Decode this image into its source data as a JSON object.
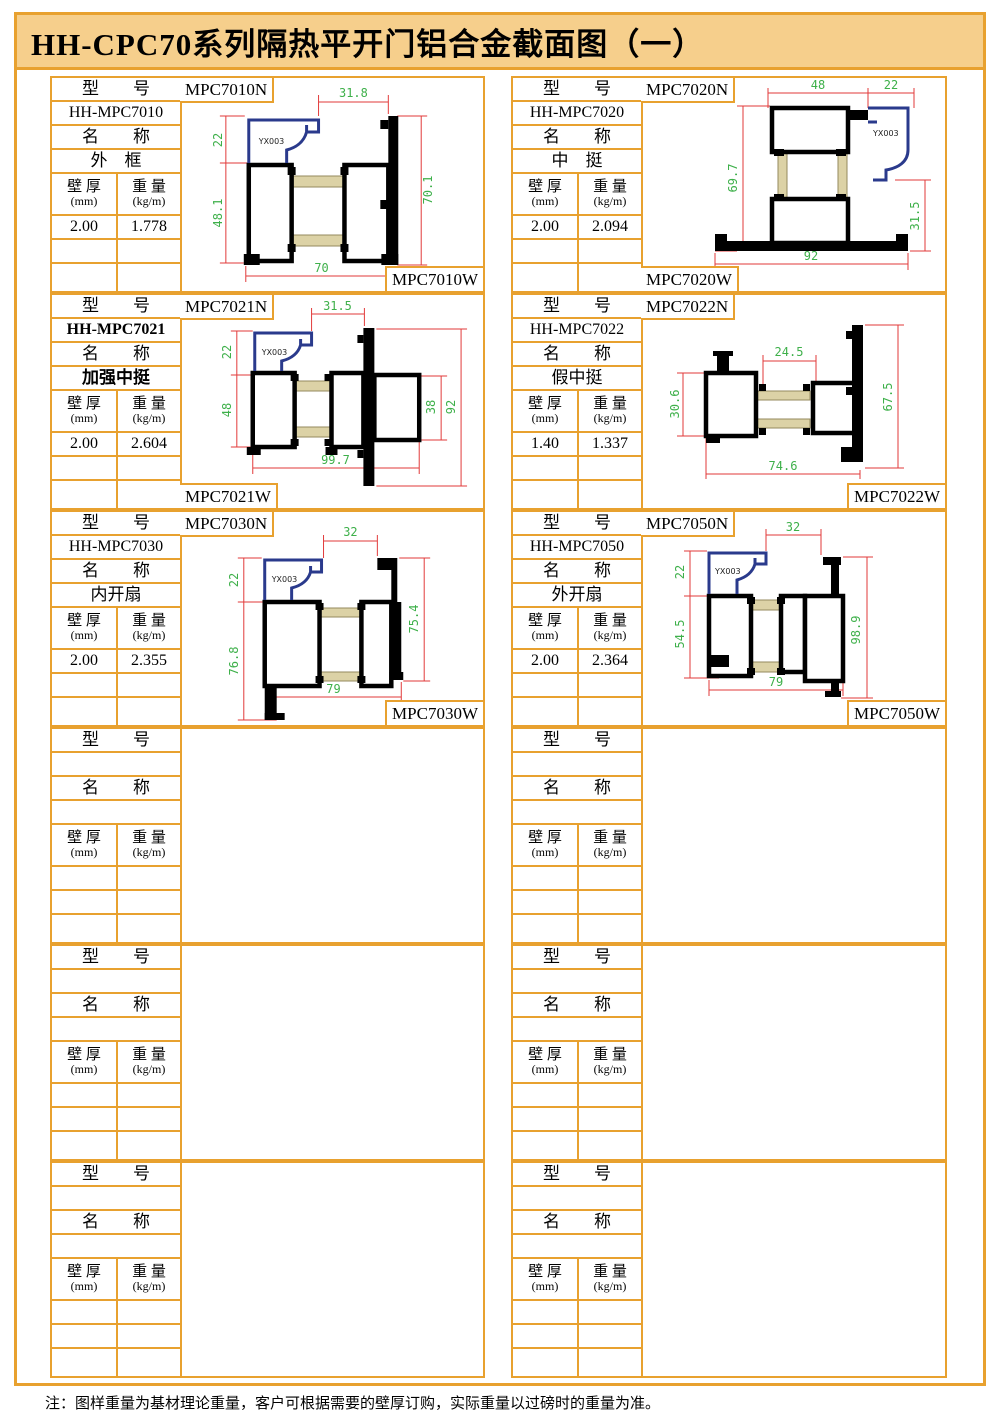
{
  "title": "HH-CPC70系列隔热平开门铝合金截面图（一）",
  "note": "注：图样重量为基材理论重量，客户可根据需要的壁厚订购，实际重量以过磅时的重量为准。",
  "labels": {
    "model": "型　　号",
    "name": "名　　称",
    "thickness": "壁 厚",
    "thickness_unit": "(mm)",
    "weight": "重 量",
    "weight_unit": "(kg/m)"
  },
  "colors": {
    "frame_orange": "#E8A12F",
    "title_bg": "#F6CF8C",
    "dimension_line_red": "#E23A3A",
    "dimension_text_green": "#3EB04A",
    "gasket_blue": "#2A3A8C",
    "thermal_break_tan": "#DCD2A6"
  },
  "cells": [
    {
      "model": "HH-MPC7010",
      "name": "外　框",
      "thickness": "2.00",
      "weight": "1.778",
      "label_n": "MPC7010N",
      "label_w": "MPC7010W",
      "gasket": "YX003",
      "dims": {
        "top": "31.8",
        "left_top": "22",
        "left": "48.1",
        "right": "70.1",
        "bottom": "70"
      }
    },
    {
      "model": "HH-MPC7020",
      "name": "中　挺",
      "thickness": "2.00",
      "weight": "2.094",
      "label_n": "MPC7020N",
      "label_w": "MPC7020W",
      "gasket": "YX003",
      "dims": {
        "top_left": "48",
        "top_right": "22",
        "left": "69.7",
        "right": "31.5",
        "bottom": "92"
      }
    },
    {
      "model": "HH-MPC7021",
      "name": "加强中挺",
      "thickness": "2.00",
      "weight": "2.604",
      "label_n": "MPC7021N",
      "label_w": "MPC7021W",
      "gasket": "YX003",
      "dims": {
        "top": "31.5",
        "left_top": "22",
        "left": "48",
        "mid": "38",
        "right": "92",
        "bottom": "99.7"
      }
    },
    {
      "model": "HH-MPC7022",
      "name": "假中挺",
      "thickness": "1.40",
      "weight": "1.337",
      "label_n": "MPC7022N",
      "label_w": "MPC7022W",
      "dims": {
        "top": "24.5",
        "left": "30.6",
        "right": "67.5",
        "bottom": "74.6"
      }
    },
    {
      "model": "HH-MPC7030",
      "name": "内开扇",
      "thickness": "2.00",
      "weight": "2.355",
      "label_n": "MPC7030N",
      "label_w": "MPC7030W",
      "gasket": "YX003",
      "dims": {
        "top": "32",
        "left_top": "22",
        "left": "76.8",
        "right": "75.4",
        "bottom": "79"
      }
    },
    {
      "model": "HH-MPC7050",
      "name": "外开扇",
      "thickness": "2.00",
      "weight": "2.364",
      "label_n": "MPC7050N",
      "label_w": "MPC7050W",
      "gasket": "YX003",
      "dims": {
        "top": "32",
        "left_top": "22",
        "left": "54.5",
        "right": "98.9",
        "bottom": "79"
      }
    }
  ]
}
